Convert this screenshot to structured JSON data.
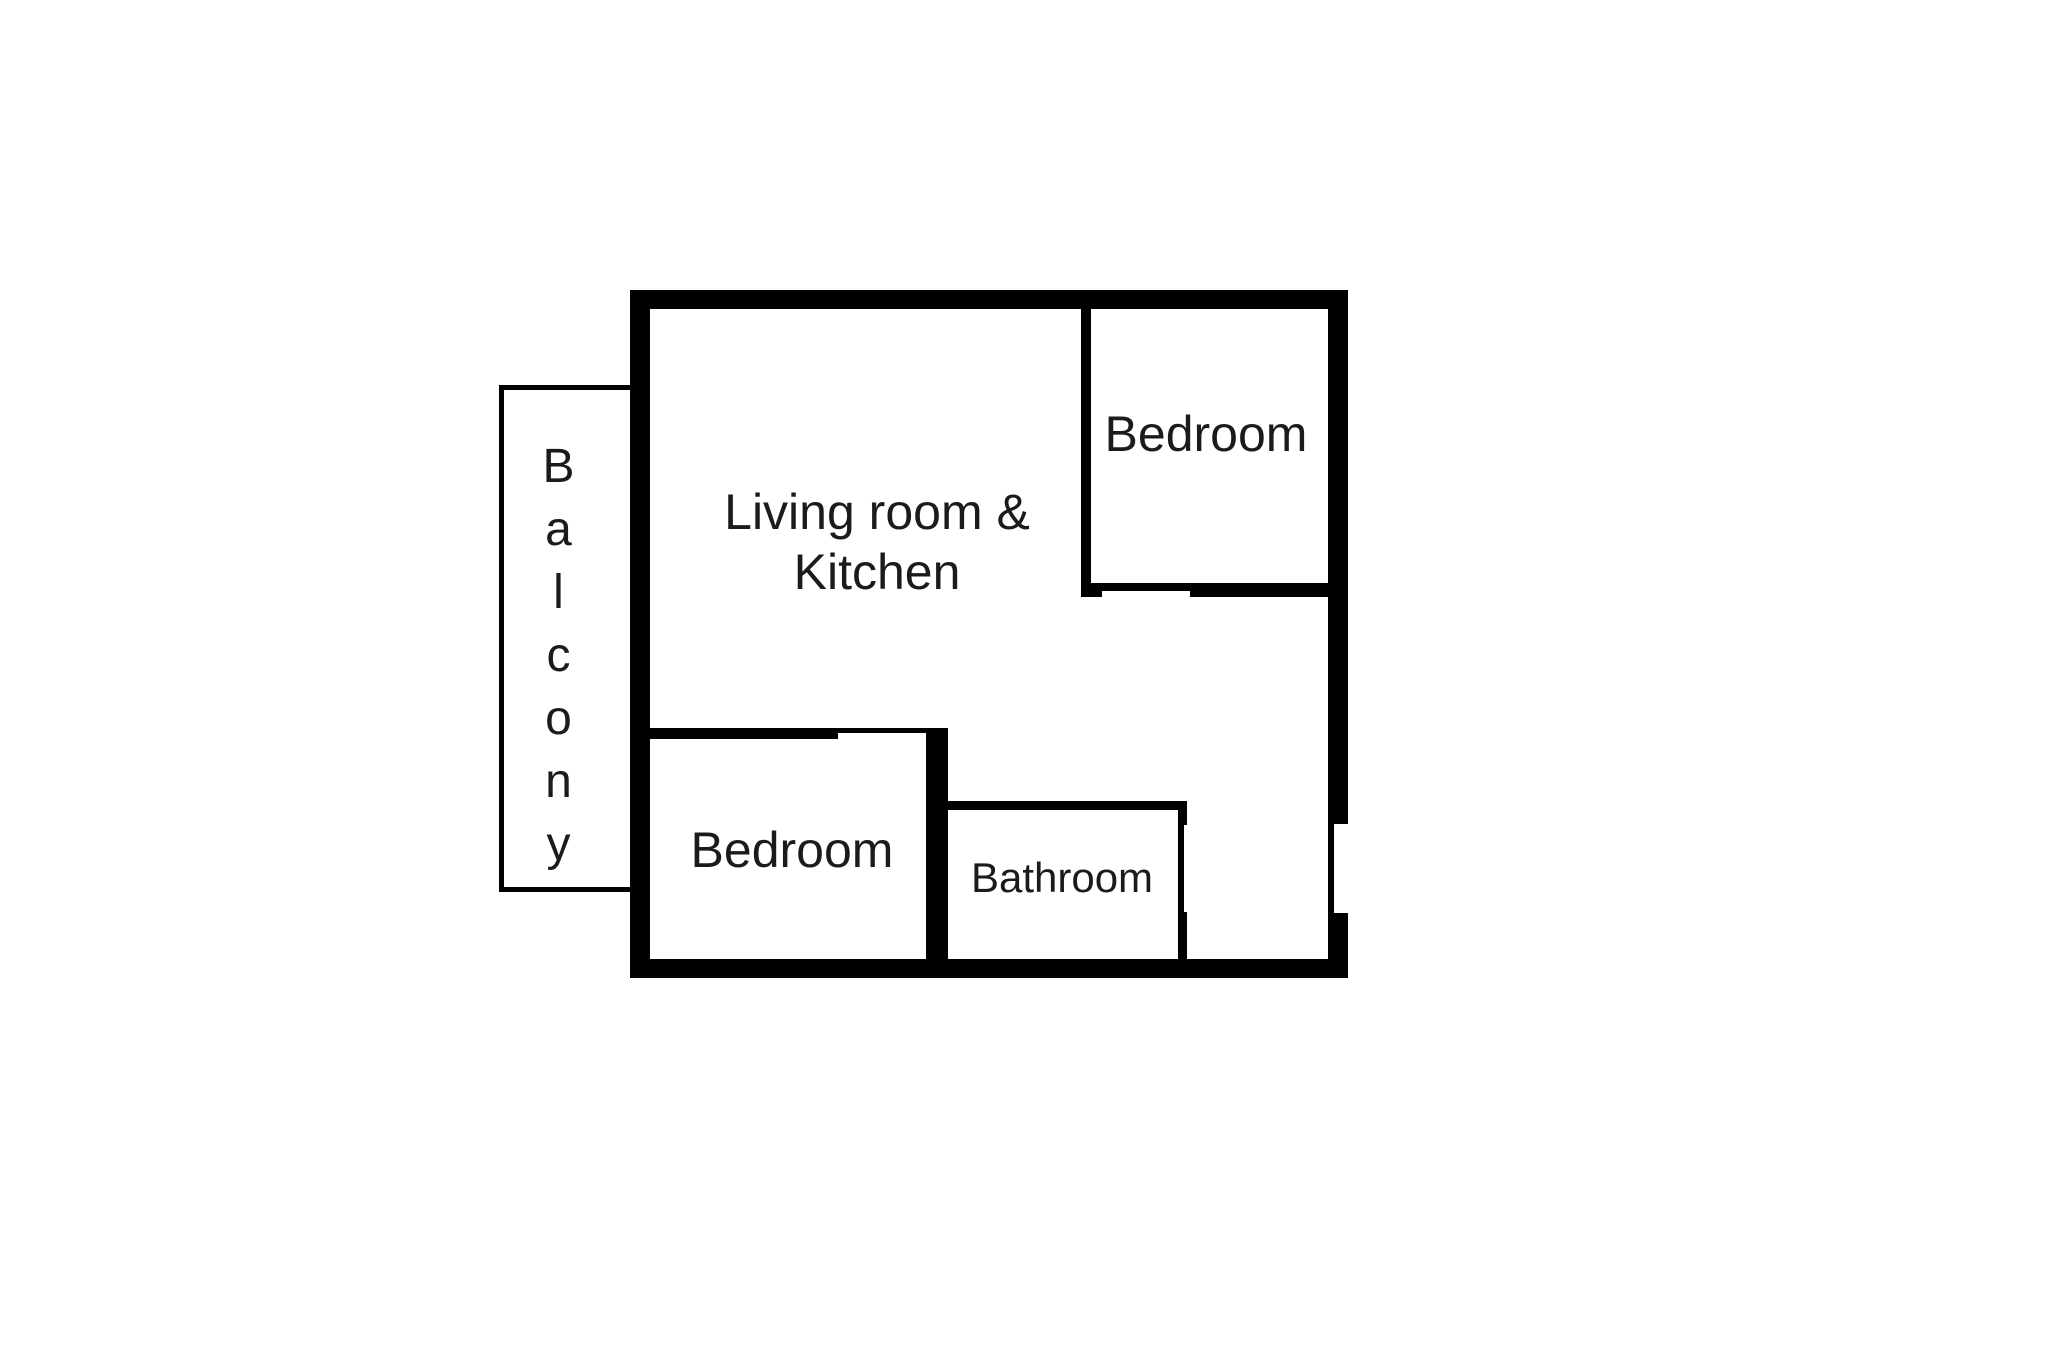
{
  "figure": {
    "type": "floor-plan",
    "background_color": "#ffffff",
    "wall_color": "#000000",
    "text_color": "#1b1b1b"
  },
  "rooms": {
    "living_kitchen": {
      "lines": [
        "Living room &",
        "Kitchen"
      ]
    },
    "bedroom_top_right": {
      "label": "Bedroom"
    },
    "bedroom_bottom_left": {
      "label": "Bedroom"
    },
    "bathroom": {
      "label": "Bathroom"
    },
    "balcony": {
      "label": "Balcony"
    }
  }
}
